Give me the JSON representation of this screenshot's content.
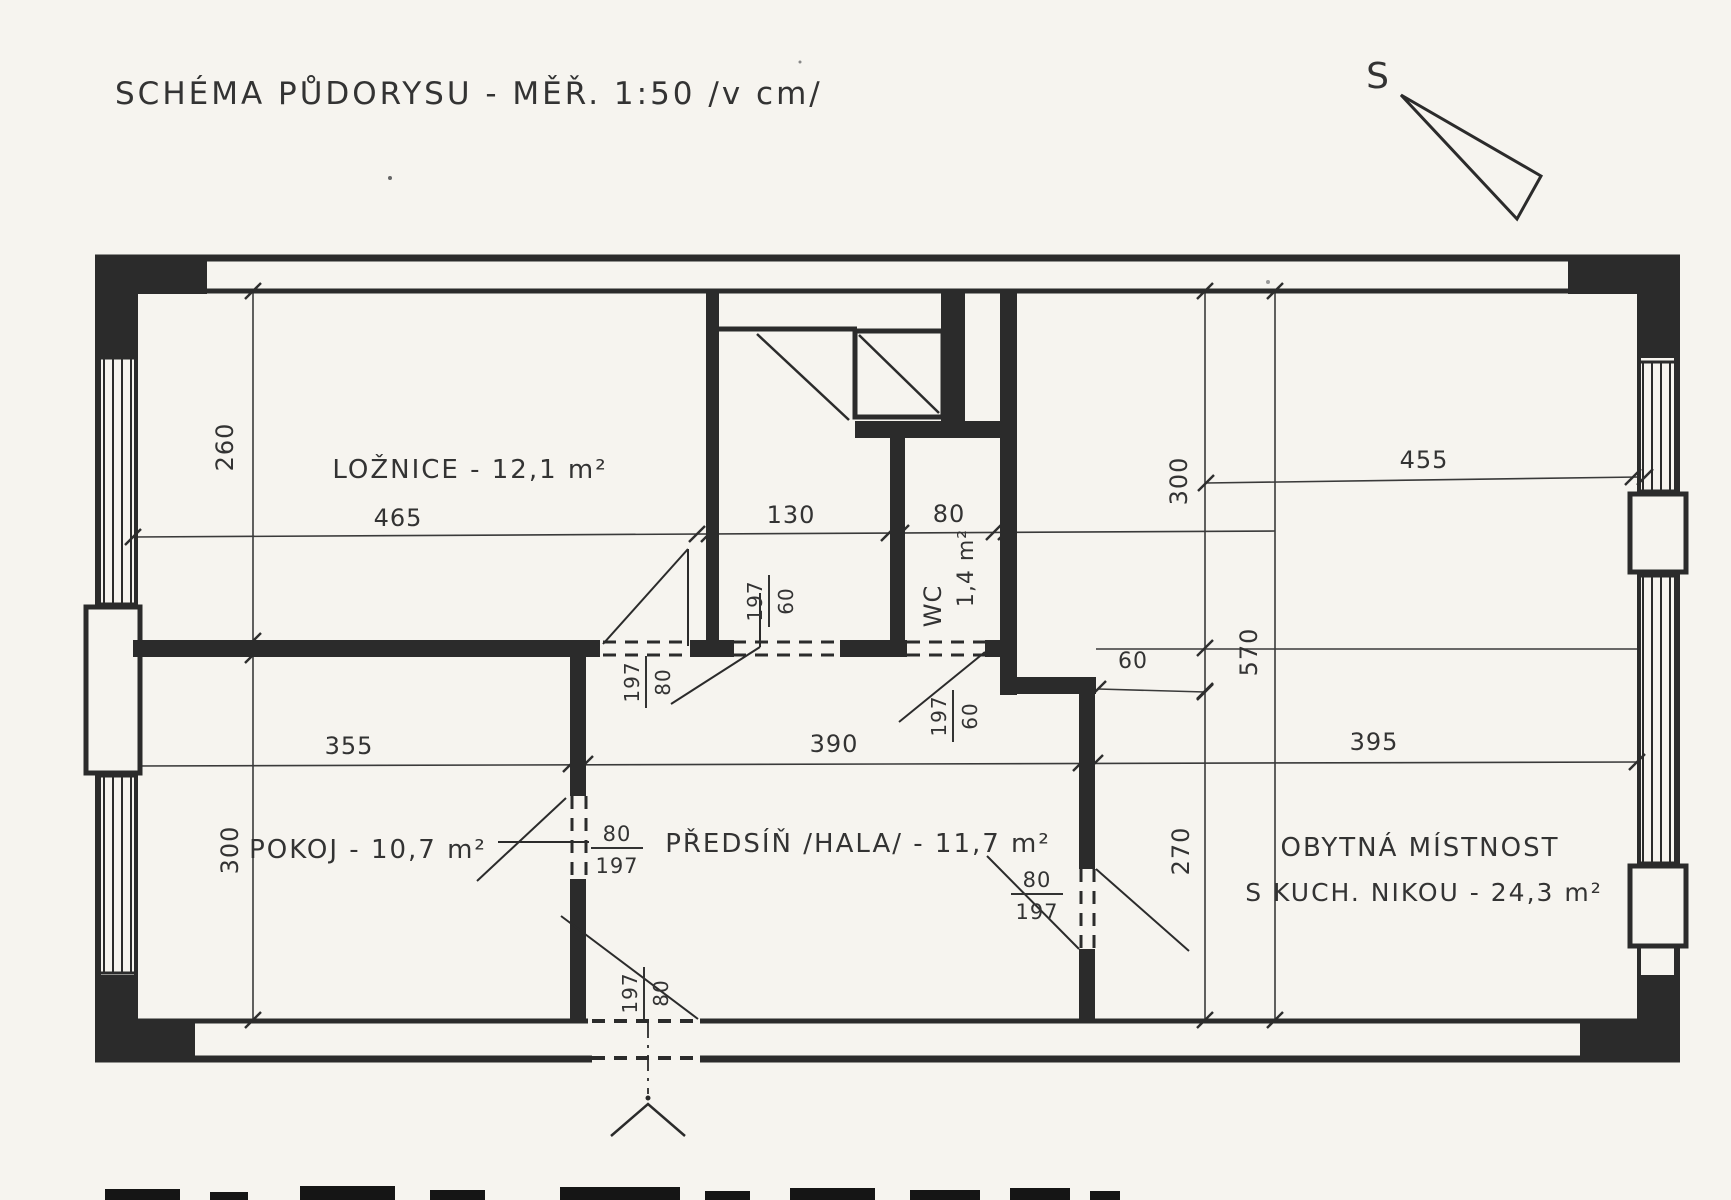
{
  "document": {
    "title": "SCHÉMA PŮDORYSU - MĚŘ. 1:50 /v cm/",
    "type": "hand-drawn floor plan scan",
    "scale": "1:50",
    "units": "cm"
  },
  "compass": {
    "label": "S"
  },
  "rooms": [
    {
      "name": "LOŽNICE",
      "area_m2": "12,1"
    },
    {
      "name": "POKOJ",
      "area_m2": "10,7"
    },
    {
      "name": "PŘEDSÍŇ /HALA/",
      "area_m2": "11,7"
    },
    {
      "name": "WC",
      "area_m2": "1,4"
    },
    {
      "name": "OBYTNÁ MÍSTNOST S KUCH. NIKOU",
      "area_m2": "24,3"
    }
  ],
  "dimensions_cm": {
    "horizontal_top_chain": [
      465,
      130,
      80,
      455
    ],
    "horizontal_mid_chain": [
      355,
      390,
      395
    ],
    "vertical": [
      260,
      300,
      570,
      300,
      270
    ],
    "small": [
      60
    ],
    "door_sizes": [
      "80/197",
      "80/197",
      "80/197",
      "80/197",
      "60/197",
      "60/197"
    ]
  },
  "annotations": [
    {
      "name": "page-title",
      "type": "text",
      "text": "SCHÉMA PŮDORYSU - MĚŘ. 1:50 /v cm/",
      "x": 115,
      "y": 104,
      "size": 31,
      "ls": 3,
      "anchor": "start",
      "rot": 0
    },
    {
      "name": "compass-s-label",
      "type": "text",
      "text": "S",
      "x": 1378,
      "y": 88,
      "size": 36,
      "ls": 0,
      "anchor": "middle",
      "rot": 0
    },
    {
      "name": "room-label-loznice",
      "type": "text",
      "text": "LOŽNICE - 12,1 m²",
      "x": 470,
      "y": 478,
      "size": 26,
      "ls": 2,
      "anchor": "middle",
      "rot": 0
    },
    {
      "name": "room-label-pokoj",
      "type": "text",
      "text": "POKOJ - 10,7 m²",
      "x": 368,
      "y": 858,
      "size": 26,
      "ls": 2,
      "anchor": "middle",
      "rot": 0
    },
    {
      "name": "room-label-predsin",
      "type": "text",
      "text": "PŘEDSÍŇ /HALA/ - 11,7 m²",
      "x": 858,
      "y": 852,
      "size": 26,
      "ls": 2,
      "anchor": "middle",
      "rot": 0
    },
    {
      "name": "room-label-obytna-1",
      "type": "text",
      "text": "OBYTNÁ MÍSTNOST",
      "x": 1420,
      "y": 856,
      "size": 26,
      "ls": 2,
      "anchor": "middle",
      "rot": 0
    },
    {
      "name": "room-label-obytna-2",
      "type": "text",
      "text": "S KUCH. NIKOU - 24,3 m²",
      "x": 1424,
      "y": 901,
      "size": 25,
      "ls": 2,
      "anchor": "middle",
      "rot": 0
    },
    {
      "name": "room-label-wc",
      "type": "text",
      "text": "WC",
      "x": 941,
      "y": 606,
      "size": 24,
      "ls": 1,
      "anchor": "middle",
      "rot": -90
    },
    {
      "name": "room-label-wc-area",
      "type": "text",
      "text": "1,4 m²",
      "x": 973,
      "y": 568,
      "size": 22,
      "ls": 1,
      "anchor": "middle",
      "rot": -90
    },
    {
      "name": "dim-465",
      "type": "text",
      "text": "465",
      "x": 398,
      "y": 526,
      "size": 24,
      "ls": 1,
      "anchor": "middle",
      "rot": 0
    },
    {
      "name": "dim-130",
      "type": "text",
      "text": "130",
      "x": 791,
      "y": 523,
      "size": 24,
      "ls": 1,
      "anchor": "middle",
      "rot": 0
    },
    {
      "name": "dim-80-wc",
      "type": "text",
      "text": "80",
      "x": 949,
      "y": 522,
      "size": 24,
      "ls": 1,
      "anchor": "middle",
      "rot": 0
    },
    {
      "name": "dim-455",
      "type": "text",
      "text": "455",
      "x": 1424,
      "y": 468,
      "size": 24,
      "ls": 1,
      "anchor": "middle",
      "rot": 0
    },
    {
      "name": "dim-355",
      "type": "text",
      "text": "355",
      "x": 349,
      "y": 754,
      "size": 24,
      "ls": 1,
      "anchor": "middle",
      "rot": 0
    },
    {
      "name": "dim-390",
      "type": "text",
      "text": "390",
      "x": 834,
      "y": 752,
      "size": 24,
      "ls": 1,
      "anchor": "middle",
      "rot": 0
    },
    {
      "name": "dim-395",
      "type": "text",
      "text": "395",
      "x": 1374,
      "y": 750,
      "size": 24,
      "ls": 1,
      "anchor": "middle",
      "rot": 0
    },
    {
      "name": "dim-60",
      "type": "text",
      "text": "60",
      "x": 1133,
      "y": 668,
      "size": 22,
      "ls": 1,
      "anchor": "middle",
      "rot": 0
    },
    {
      "name": "dim-260",
      "type": "text",
      "text": "260",
      "x": 233,
      "y": 447,
      "size": 24,
      "ls": 1,
      "anchor": "middle",
      "rot": -90
    },
    {
      "name": "dim-300-left",
      "type": "text",
      "text": "300",
      "x": 238,
      "y": 850,
      "size": 24,
      "ls": 1,
      "anchor": "middle",
      "rot": -90
    },
    {
      "name": "dim-300-right",
      "type": "text",
      "text": "300",
      "x": 1187,
      "y": 481,
      "size": 24,
      "ls": 1,
      "anchor": "middle",
      "rot": -90
    },
    {
      "name": "dim-570",
      "type": "text",
      "text": "570",
      "x": 1257,
      "y": 652,
      "size": 24,
      "ls": 1,
      "anchor": "middle",
      "rot": -90
    },
    {
      "name": "dim-270",
      "type": "text",
      "text": "270",
      "x": 1189,
      "y": 851,
      "size": 24,
      "ls": 1,
      "anchor": "middle",
      "rot": -90
    },
    {
      "name": "door-label-pokoj",
      "type": "fraction",
      "num": "80",
      "den": "197",
      "x": 617,
      "y": 848,
      "size": 21,
      "rot": 0
    },
    {
      "name": "door-label-obytna",
      "type": "fraction",
      "num": "80",
      "den": "197",
      "x": 1037,
      "y": 894,
      "size": 21,
      "rot": 0
    },
    {
      "name": "door-label-loznice",
      "type": "fraction",
      "num": "197",
      "den": "80",
      "x": 646,
      "y": 682,
      "size": 20,
      "rot": -90
    },
    {
      "name": "door-label-closet",
      "type": "fraction",
      "num": "197",
      "den": "60",
      "x": 769,
      "y": 601,
      "size": 20,
      "rot": -90
    },
    {
      "name": "door-label-wc",
      "type": "fraction",
      "num": "197",
      "den": "60",
      "x": 953,
      "y": 716,
      "size": 20,
      "rot": -90
    },
    {
      "name": "door-label-entrance",
      "type": "fraction",
      "num": "197",
      "den": "80",
      "x": 644,
      "y": 993,
      "size": 20,
      "rot": -90
    }
  ]
}
